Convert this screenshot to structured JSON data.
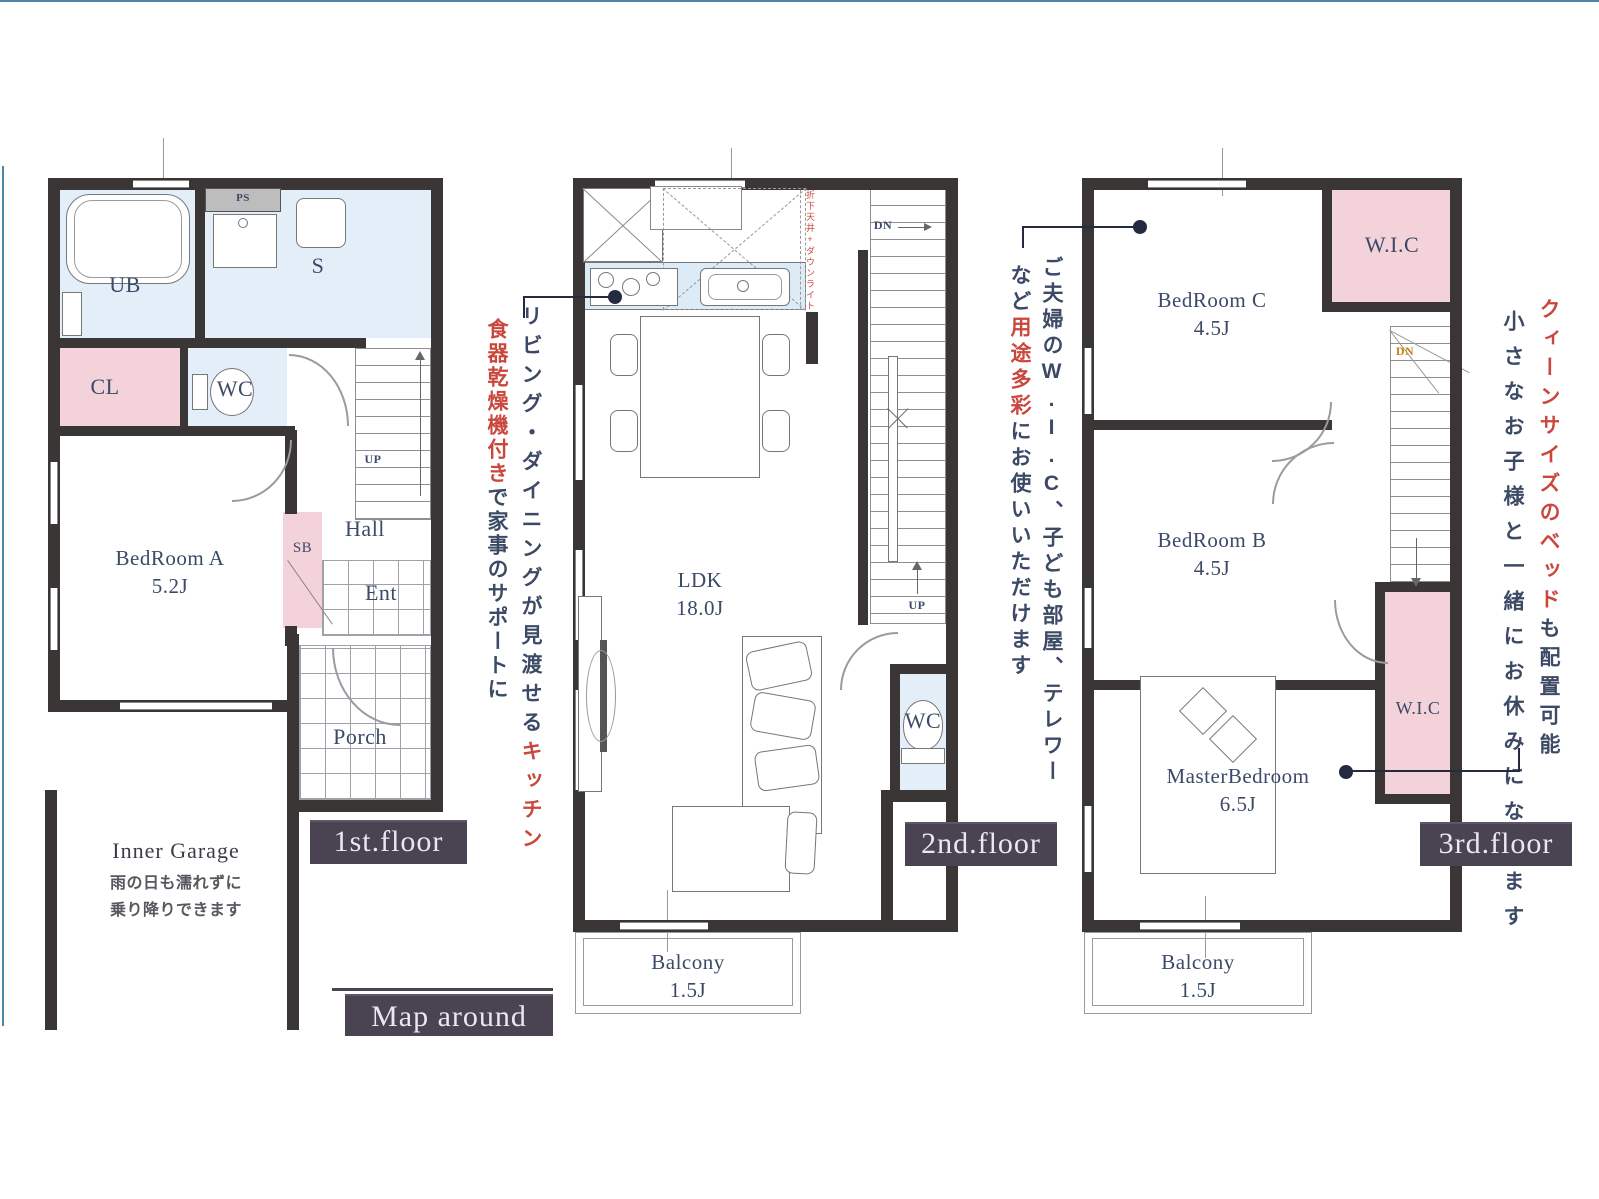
{
  "badges": {
    "floor1": "1st.floor",
    "floor2": "2nd.floor",
    "floor3": "3rd.floor",
    "map": "Map around"
  },
  "f1": {
    "ub": "UB",
    "ps": "PS",
    "s": "S",
    "cl": "CL",
    "wc": "WC",
    "bedroom_a": "BedRoom A",
    "bedroom_a_size": "5.2J",
    "sb": "SB",
    "hall": "Hall",
    "ent": "Ent",
    "porch": "Porch",
    "up": "UP",
    "garage_title": "Inner Garage",
    "garage_note1": "雨の日も濡れずに",
    "garage_note2": "乗り降りできます"
  },
  "f2": {
    "ldk": "LDK",
    "ldk_size": "18.0J",
    "wc": "WC",
    "dn": "DN",
    "up": "UP",
    "balcony": "Balcony",
    "balcony_size": "1.5J",
    "kitchen_note": "折下天井+ダウンライト"
  },
  "f3": {
    "bedroom_c": "BedRoom C",
    "bedroom_c_size": "4.5J",
    "wic_top": "W.I.C",
    "dn": "DN",
    "bedroom_b": "BedRoom B",
    "bedroom_b_size": "4.5J",
    "master": "MasterBedroom",
    "master_size": "6.5J",
    "wic_bottom": "W.I.C",
    "balcony": "Balcony",
    "balcony_size": "1.5J"
  },
  "ann": {
    "kitchen_col1_navy": "リビング・ダイニングが見渡せる",
    "kitchen_col1_red": "キッチン",
    "kitchen_col2_red": "食器乾燥機付き",
    "kitchen_col2_navy": "で家事のサポートに",
    "wic_col1": "ご夫婦のW.I.C、子ども部屋、テレワー",
    "wic_col2_a": "など",
    "wic_col2_red": "用途多彩",
    "wic_col2_b": "にお使いいただけます",
    "bed_col1_red": "クィーンサイズのベッド",
    "bed_col1_navy": "も配置可能",
    "bed_col2": "小さなお子様と一緒にお休みになれます"
  },
  "colors": {
    "wall": "#3a3636",
    "room_pink": "#f3d2da",
    "room_blue": "#e4eef8",
    "counter_blue": "#dcebf6",
    "navy_text": "#3b4a68",
    "red_text": "#c9473d",
    "badge_bg": "#4a4452",
    "badge_text": "#e9e7f0",
    "frame_teal": "#4e86a8",
    "dn_orange": "#c8820a"
  }
}
